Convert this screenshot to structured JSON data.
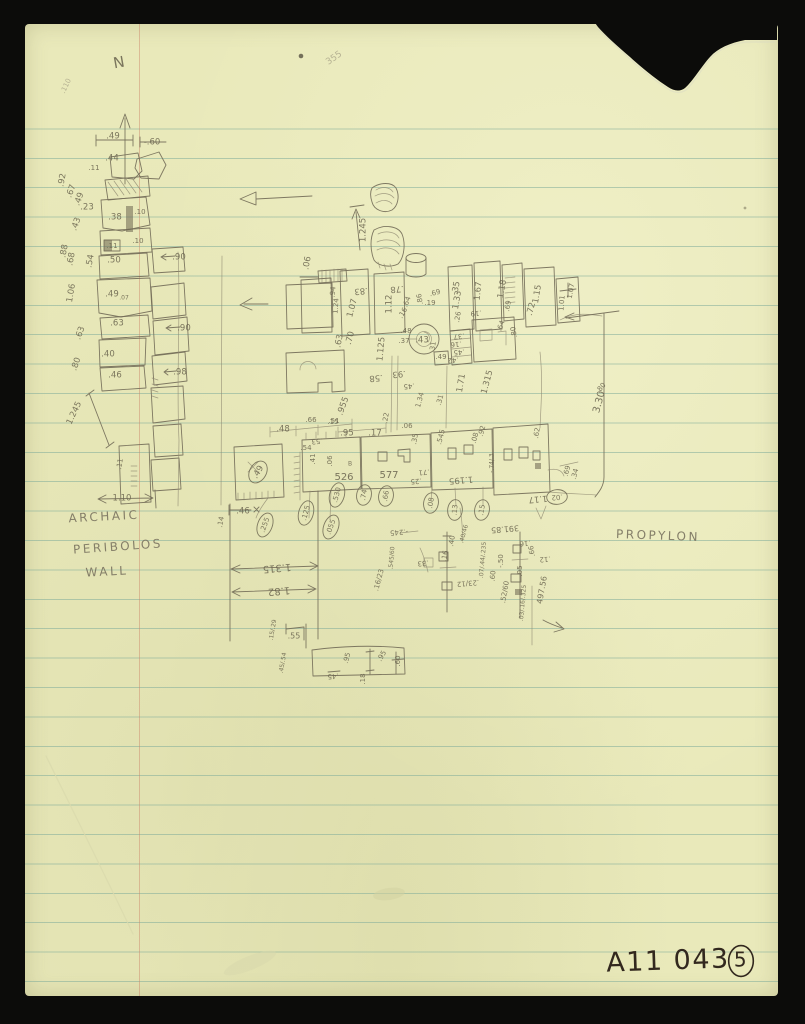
{
  "document": {
    "kind": "scanned hand-drawn archaeological sketch on ruled yellow paper",
    "catalog_number": "A11 043",
    "page_number": "5",
    "site_labels": [
      "ARCHAIC PERIBOLOS WALL",
      "PROPYLON"
    ],
    "north_indicator": "N"
  },
  "colors": {
    "scan_background": "#0c0c0a",
    "paper": "#e9e9ba",
    "rule_line": "#80ac9a",
    "margin_line": "#c98269",
    "pencil": "#6b6550",
    "ink": "#32281e"
  },
  "annotations": [
    {
      "t": "N",
      "x": 119,
      "y": 63,
      "r": -10,
      "s": 15
    },
    {
      "t": ".110",
      "x": 66,
      "y": 86,
      "r": -65,
      "s": 7,
      "k": "f"
    },
    {
      "t": ".49",
      "x": 113,
      "y": 136
    },
    {
      "t": "-.60",
      "x": 152,
      "y": 142
    },
    {
      "t": ".44",
      "x": 112,
      "y": 158
    },
    {
      "t": ".11",
      "x": 94,
      "y": 168,
      "s": 7
    },
    {
      "t": ".92",
      "x": 62,
      "y": 180,
      "r": -80
    },
    {
      "t": ".67",
      "x": 71,
      "y": 191,
      "r": -70
    },
    {
      "t": ".49",
      "x": 79,
      "y": 199,
      "r": -70
    },
    {
      "t": ".23",
      "x": 87,
      "y": 207
    },
    {
      "t": ".43",
      "x": 76,
      "y": 224,
      "r": -70
    },
    {
      "t": ".38",
      "x": 115,
      "y": 217
    },
    {
      "t": ".10",
      "x": 140,
      "y": 212,
      "s": 7
    },
    {
      "t": ".11",
      "x": 112,
      "y": 246,
      "s": 7
    },
    {
      "t": ".10",
      "x": 138,
      "y": 241,
      "s": 7
    },
    {
      "t": ".88",
      "x": 64,
      "y": 251,
      "r": -80
    },
    {
      "t": ".68",
      "x": 71,
      "y": 259,
      "r": -80
    },
    {
      "t": ".54",
      "x": 90,
      "y": 261,
      "r": -80
    },
    {
      "t": ".50",
      "x": 114,
      "y": 260
    },
    {
      "t": ".90",
      "x": 179,
      "y": 257
    },
    {
      "t": "1.06",
      "x": 71,
      "y": 293,
      "r": -80
    },
    {
      "t": ".49",
      "x": 112,
      "y": 294
    },
    {
      "t": ".07",
      "x": 124,
      "y": 298,
      "s": 6
    },
    {
      "t": ".63",
      "x": 117,
      "y": 323
    },
    {
      "t": ".63",
      "x": 80,
      "y": 333,
      "r": -70
    },
    {
      "t": ".90",
      "x": 184,
      "y": 328
    },
    {
      "t": ".40",
      "x": 108,
      "y": 354
    },
    {
      "t": ".80",
      "x": 76,
      "y": 364,
      "r": -70
    },
    {
      "t": ".46",
      "x": 115,
      "y": 375
    },
    {
      "t": ".98",
      "x": 180,
      "y": 372
    },
    {
      "t": "1.245",
      "x": 74,
      "y": 413,
      "r": -65
    },
    {
      "t": ".11",
      "x": 120,
      "y": 464,
      "r": -80,
      "s": 7
    },
    {
      "t": "1.10",
      "x": 122,
      "y": 498
    },
    {
      "t": "ARCHAIC",
      "x": 104,
      "y": 517,
      "r": -3,
      "s": 12,
      "k": "l"
    },
    {
      "t": "PERIBOLOS",
      "x": 118,
      "y": 547,
      "r": -4,
      "s": 12,
      "k": "l"
    },
    {
      "t": "WALL",
      "x": 107,
      "y": 572,
      "r": -3,
      "s": 12,
      "k": "l"
    },
    {
      "t": "PROPYLON",
      "x": 658,
      "y": 536,
      "r": 2,
      "s": 12,
      "k": "l"
    },
    {
      "t": "355",
      "x": 334,
      "y": 58,
      "r": -35,
      "s": 9,
      "k": "f"
    },
    {
      "t": "1.245",
      "x": 363,
      "y": 230,
      "r": -90
    },
    {
      "t": ".06",
      "x": 307,
      "y": 263,
      "r": -80
    },
    {
      "t": ".83",
      "x": 361,
      "y": 291,
      "r": 175
    },
    {
      "t": "1.07",
      "x": 352,
      "y": 308,
      "r": -75
    },
    {
      "t": ".94",
      "x": 333,
      "y": 292,
      "r": -85,
      "s": 7
    },
    {
      "t": "1.24",
      "x": 336,
      "y": 306,
      "r": -85,
      "s": 7
    },
    {
      "t": ".78",
      "x": 397,
      "y": 289,
      "r": 175
    },
    {
      "t": "1.12",
      "x": 389,
      "y": 304,
      "r": -90
    },
    {
      "t": ".64",
      "x": 407,
      "y": 302,
      "r": -70,
      "s": 7
    },
    {
      "t": ".16",
      "x": 403,
      "y": 313,
      "r": -60,
      "s": 7
    },
    {
      "t": ".86",
      "x": 420,
      "y": 299,
      "r": -100,
      "s": 7
    },
    {
      "t": ".69",
      "x": 435,
      "y": 293,
      "r": -15,
      "s": 7
    },
    {
      "t": ".19",
      "x": 430,
      "y": 303,
      "s": 7
    },
    {
      "t": ".35",
      "x": 456,
      "y": 288,
      "r": -80
    },
    {
      "t": "1.33",
      "x": 457,
      "y": 300,
      "r": -80
    },
    {
      "t": ".26",
      "x": 458,
      "y": 317,
      "r": -80,
      "s": 7
    },
    {
      "t": "1.67",
      "x": 478,
      "y": 291,
      "r": -85
    },
    {
      "t": ".19",
      "x": 476,
      "y": 313,
      "r": 175,
      "s": 7
    },
    {
      "t": "1.18",
      "x": 502,
      "y": 289,
      "r": -80
    },
    {
      "t": ".69",
      "x": 508,
      "y": 306,
      "r": -80,
      "s": 7
    },
    {
      "t": "1.15",
      "x": 537,
      "y": 294,
      "r": -80
    },
    {
      "t": ".72",
      "x": 531,
      "y": 309,
      "r": -75
    },
    {
      "t": "1.01",
      "x": 562,
      "y": 303,
      "r": -85,
      "s": 7
    },
    {
      "t": "1.07",
      "x": 571,
      "y": 291,
      "r": -80,
      "s": 7
    },
    {
      "t": ".64",
      "x": 501,
      "y": 326,
      "r": -70,
      "s": 7
    },
    {
      "t": ".80",
      "x": 514,
      "y": 332,
      "r": -100,
      "s": 7
    },
    {
      "t": ".48",
      "x": 406,
      "y": 331,
      "s": 7
    },
    {
      "t": ".37",
      "x": 404,
      "y": 341,
      "s": 7
    },
    {
      "t": ".43",
      "x": 422,
      "y": 340
    },
    {
      "t": ".63",
      "x": 339,
      "y": 341,
      "r": -80
    },
    {
      "t": ".70",
      "x": 350,
      "y": 338,
      "r": -75
    },
    {
      "t": "1.125",
      "x": 381,
      "y": 349,
      "r": -85
    },
    {
      "t": ".31",
      "x": 433,
      "y": 347,
      "r": -80,
      "s": 7
    },
    {
      "t": ".49",
      "x": 441,
      "y": 357,
      "s": 7
    },
    {
      "t": ".37",
      "x": 459,
      "y": 336,
      "r": 175,
      "s": 7
    },
    {
      "t": ".16",
      "x": 456,
      "y": 344,
      "r": 175,
      "s": 7
    },
    {
      "t": ".45",
      "x": 459,
      "y": 352,
      "r": 175,
      "s": 7
    },
    {
      "t": ".42",
      "x": 453,
      "y": 360,
      "r": 175,
      "s": 7
    },
    {
      "t": ".93",
      "x": 399,
      "y": 374,
      "r": 175
    },
    {
      "t": ".58",
      "x": 376,
      "y": 378,
      "r": 175
    },
    {
      "t": ".45",
      "x": 409,
      "y": 386,
      "r": 175,
      "s": 7
    },
    {
      "t": "1.71",
      "x": 461,
      "y": 383,
      "r": -80
    },
    {
      "t": "1.315",
      "x": 487,
      "y": 382,
      "r": -75
    },
    {
      "t": "3.30",
      "x": 599,
      "y": 402,
      "r": -75,
      "s": 10
    },
    {
      "t": ".80",
      "x": 601,
      "y": 388,
      "r": -50,
      "s": 7
    },
    {
      "t": ".955",
      "x": 343,
      "y": 406,
      "r": -70
    },
    {
      "t": ".15",
      "x": 333,
      "y": 422,
      "s": 7
    },
    {
      "t": ".48",
      "x": 283,
      "y": 429
    },
    {
      "t": ".66",
      "x": 311,
      "y": 420,
      "s": 7
    },
    {
      "t": ".51",
      "x": 334,
      "y": 421,
      "s": 7
    },
    {
      "t": ".53",
      "x": 317,
      "y": 441,
      "r": 175,
      "s": 7
    },
    {
      "t": ".95",
      "x": 347,
      "y": 433
    },
    {
      "t": ".17",
      "x": 375,
      "y": 433
    },
    {
      "t": ".22",
      "x": 386,
      "y": 418,
      "r": -80,
      "s": 7
    },
    {
      "t": "1.34",
      "x": 420,
      "y": 400,
      "r": -75,
      "s": 7
    },
    {
      "t": ".31",
      "x": 440,
      "y": 400,
      "r": -75,
      "s": 7
    },
    {
      "t": ".06",
      "x": 407,
      "y": 426,
      "s": 7
    },
    {
      "t": ".35",
      "x": 415,
      "y": 439,
      "r": -80,
      "s": 7
    },
    {
      "t": ".545",
      "x": 441,
      "y": 437,
      "r": -75,
      "s": 7
    },
    {
      "t": ".92",
      "x": 482,
      "y": 431,
      "r": -75,
      "s": 7
    },
    {
      "t": ".08",
      "x": 475,
      "y": 438,
      "r": -75,
      "s": 7
    },
    {
      "t": ".54",
      "x": 306,
      "y": 448,
      "s": 7
    },
    {
      "t": ".41",
      "x": 313,
      "y": 459,
      "r": -90,
      "s": 7
    },
    {
      "t": ".06",
      "x": 330,
      "y": 461,
      "r": -90,
      "s": 7
    },
    {
      "t": "526",
      "x": 344,
      "y": 477,
      "s": 10
    },
    {
      "t": "B",
      "x": 350,
      "y": 464,
      "s": 6
    },
    {
      "t": "577",
      "x": 389,
      "y": 475,
      "s": 10
    },
    {
      "t": "1.195",
      "x": 461,
      "y": 480,
      "r": 175
    },
    {
      "t": "-.74/.3",
      "x": 492,
      "y": 463,
      "r": -90,
      "s": 6
    },
    {
      "t": ".71",
      "x": 424,
      "y": 472,
      "r": 175,
      "s": 7
    },
    {
      "t": ".25",
      "x": 416,
      "y": 481,
      "r": 175,
      "s": 7
    },
    {
      "t": "1.17",
      "x": 538,
      "y": 499,
      "r": 175
    },
    {
      "t": ".62",
      "x": 537,
      "y": 433,
      "r": -80,
      "s": 7
    },
    {
      "t": ".69",
      "x": 567,
      "y": 471,
      "r": -75,
      "s": 7
    },
    {
      "t": ".34",
      "x": 575,
      "y": 474,
      "r": -75,
      "s": 7
    },
    {
      "t": ".49",
      "x": 258,
      "y": 472,
      "r": -60,
      "c": 1
    },
    {
      "t": ".530",
      "x": 337,
      "y": 495,
      "r": -75,
      "c": 1,
      "s": 7
    },
    {
      "t": ".74",
      "x": 364,
      "y": 495,
      "r": -80,
      "c": 1,
      "s": 7
    },
    {
      "t": ".66",
      "x": 386,
      "y": 496,
      "r": -80,
      "c": 1,
      "s": 7
    },
    {
      "t": ".08",
      "x": 431,
      "y": 503,
      "r": -80,
      "c": 1,
      "s": 7
    },
    {
      "t": ".13",
      "x": 455,
      "y": 510,
      "r": -85,
      "c": 1,
      "s": 7
    },
    {
      "t": ".15",
      "x": 482,
      "y": 510,
      "r": -80,
      "c": 1,
      "s": 7
    },
    {
      "t": ".02",
      "x": 557,
      "y": 497,
      "r": 175,
      "c": 1,
      "s": 7
    },
    {
      "t": ".255",
      "x": 265,
      "y": 525,
      "r": -70,
      "c": 1,
      "s": 7
    },
    {
      "t": ".125",
      "x": 306,
      "y": 513,
      "r": -75,
      "c": 1,
      "s": 7
    },
    {
      "t": ".055",
      "x": 331,
      "y": 527,
      "r": -70,
      "c": 1,
      "s": 7
    },
    {
      "t": ".46",
      "x": 243,
      "y": 511
    },
    {
      "t": ".14",
      "x": 221,
      "y": 522,
      "r": -80,
      "s": 7
    },
    {
      "t": "1.315",
      "x": 277,
      "y": 568,
      "r": 175,
      "s": 10
    },
    {
      "t": "1.82",
      "x": 279,
      "y": 591,
      "r": 175,
      "s": 10
    },
    {
      "t": "-.245",
      "x": 399,
      "y": 532,
      "r": 175,
      "s": 7
    },
    {
      "t": ".40/46",
      "x": 464,
      "y": 534,
      "r": -75,
      "s": 6
    },
    {
      "t": ".40",
      "x": 452,
      "y": 541,
      "r": -80,
      "s": 7
    },
    {
      "t": ".16",
      "x": 445,
      "y": 556,
      "r": -80,
      "s": 7
    },
    {
      "t": "391.85",
      "x": 505,
      "y": 529,
      "r": 175,
      "s": 8
    },
    {
      "t": ".16",
      "x": 525,
      "y": 543,
      "r": 175,
      "s": 7
    },
    {
      "t": ".66",
      "x": 532,
      "y": 551,
      "r": -100,
      "s": 7
    },
    {
      "t": ".12",
      "x": 545,
      "y": 559,
      "r": 175,
      "s": 7
    },
    {
      "t": "-.50",
      "x": 501,
      "y": 561,
      "r": -90,
      "s": 7
    },
    {
      "t": ".05",
      "x": 520,
      "y": 571,
      "r": -90,
      "s": 7
    },
    {
      "t": ".60",
      "x": 493,
      "y": 576,
      "r": -85,
      "s": 7
    },
    {
      "t": ".52/60",
      "x": 505,
      "y": 592,
      "r": -80,
      "s": 7
    },
    {
      "t": ".07/.44/.235",
      "x": 483,
      "y": 560,
      "r": -85,
      "s": 6
    },
    {
      "t": ".33",
      "x": 423,
      "y": 563,
      "r": 175,
      "s": 7
    },
    {
      "t": ".23/12",
      "x": 468,
      "y": 583,
      "r": 175,
      "s": 7
    },
    {
      "t": ".545/60",
      "x": 392,
      "y": 558,
      "r": -85,
      "s": 6
    },
    {
      "t": ".16/23",
      "x": 379,
      "y": 580,
      "r": -75,
      "s": 7
    },
    {
      "t": "497.56",
      "x": 542,
      "y": 590,
      "r": -80,
      "s": 8
    },
    {
      "t": ".03/.16/.325",
      "x": 523,
      "y": 603,
      "r": -85,
      "s": 6
    },
    {
      "t": ".55",
      "x": 294,
      "y": 636,
      "s": 8
    },
    {
      "t": ".15/.29",
      "x": 273,
      "y": 630,
      "r": -80,
      "s": 6
    },
    {
      "t": ".45/.54",
      "x": 283,
      "y": 663,
      "r": -80,
      "s": 6
    },
    {
      "t": ".95",
      "x": 347,
      "y": 658,
      "r": -75,
      "s": 7
    },
    {
      "t": ".45",
      "x": 333,
      "y": 676,
      "r": 175,
      "s": 7
    },
    {
      "t": ".18",
      "x": 363,
      "y": 679,
      "r": -90,
      "s": 7
    },
    {
      "t": ".95",
      "x": 382,
      "y": 656,
      "r": -60,
      "s": 7
    },
    {
      "t": ".60",
      "x": 398,
      "y": 661,
      "r": -90,
      "s": 7
    },
    {
      "t": "A11 043",
      "x": 668,
      "y": 962,
      "r": -2,
      "s": 27,
      "k": "i"
    },
    {
      "t": "5",
      "x": 741,
      "y": 961,
      "s": 20,
      "k": "i",
      "c": 1
    }
  ]
}
